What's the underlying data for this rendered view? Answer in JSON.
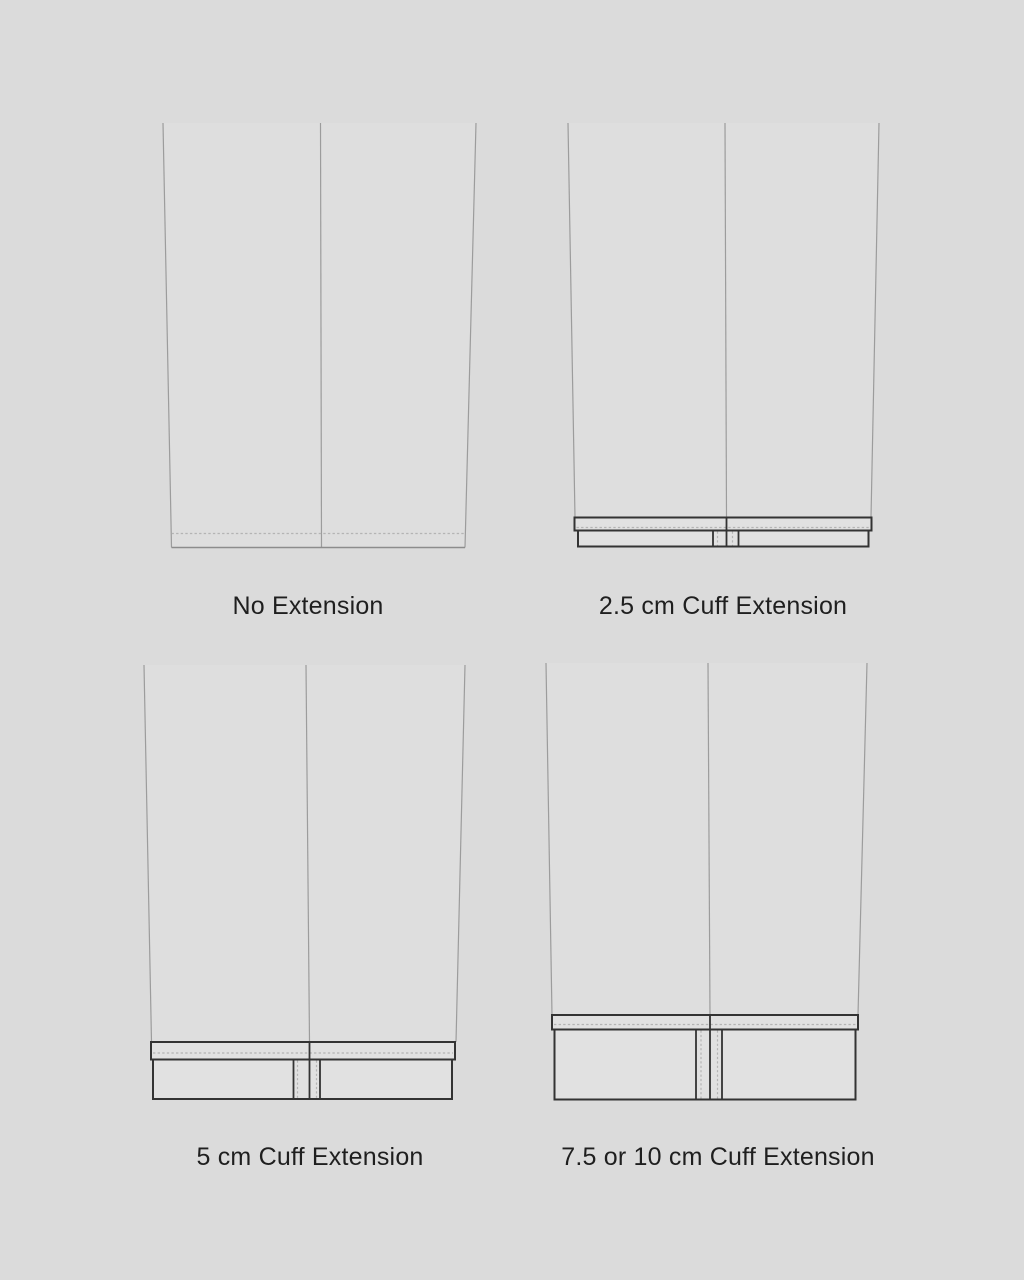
{
  "figure": {
    "title": "Trouser hem cuff extension options",
    "colors": {
      "background": "#dbdbdb",
      "leg_fill": "#dedede",
      "leg_line": "#9c9c9c",
      "cuff_fill": "#e1e1e1",
      "cuff_line": "#333333",
      "hem_line": "#8c8c8c",
      "dash": "#b4b4b4",
      "caption": "#1f1f1f"
    },
    "panels": [
      {
        "name": "no-extension",
        "caption": "No Extension",
        "leg": {
          "top": 123,
          "bottom": 547.5,
          "left": [
            163,
            171.5
          ],
          "crease": [
            320.5,
            321.5
          ],
          "right": [
            476,
            465
          ]
        },
        "hem": {
          "y": 547.5,
          "fold_y": 533.5,
          "x1": 171.5,
          "x2": 465
        },
        "cuff": null
      },
      {
        "name": "cuff-2-5cm",
        "caption": "2.5 cm Cuff Extension",
        "leg": {
          "top": 123,
          "bottom": 517.5,
          "left": [
            568,
            575
          ],
          "crease": [
            725,
            726.5
          ],
          "right": [
            879,
            871
          ]
        },
        "hem": null,
        "cuff": {
          "band1": {
            "x1": 574.5,
            "y1": 517.5,
            "x2": 871.5,
            "y2": 530.5,
            "fold_y": 527.5
          },
          "band2": {
            "x1": 578,
            "y1": 530.5,
            "x2": 868.5,
            "y2": 546.5
          },
          "crease_x": 726.5,
          "solid_x": [
            713,
            738.5
          ],
          "dash_x": [
            717.5,
            732.5
          ]
        }
      },
      {
        "name": "cuff-5cm",
        "caption": "5 cm Cuff Extension",
        "leg": {
          "top": 665,
          "bottom": 1042,
          "left": [
            144,
            151.5
          ],
          "crease": [
            306,
            309.5
          ],
          "right": [
            465,
            456
          ]
        },
        "hem": null,
        "cuff": {
          "band1": {
            "x1": 151,
            "y1": 1042,
            "x2": 455,
            "y2": 1059.5,
            "fold_y": 1053
          },
          "band2": {
            "x1": 153,
            "y1": 1059.5,
            "x2": 452,
            "y2": 1099
          },
          "crease_x": 309.5,
          "solid_x": [
            293.5,
            320
          ],
          "dash_x": [
            297.5,
            316.5
          ]
        }
      },
      {
        "name": "cuff-7-5-or-10cm",
        "caption": "7.5 or 10 cm Cuff Extension",
        "leg": {
          "top": 663,
          "bottom": 1015,
          "left": [
            546,
            552
          ],
          "crease": [
            708,
            710
          ],
          "right": [
            867,
            858
          ]
        },
        "hem": null,
        "cuff": {
          "band1": {
            "x1": 552,
            "y1": 1015,
            "x2": 858,
            "y2": 1029.5,
            "fold_y": 1024.5
          },
          "band2": {
            "x1": 554.5,
            "y1": 1029.5,
            "x2": 855.5,
            "y2": 1099.5
          },
          "crease_x": 710,
          "solid_x": [
            696,
            722
          ],
          "dash_x": [
            701,
            717.5
          ]
        }
      }
    ]
  }
}
